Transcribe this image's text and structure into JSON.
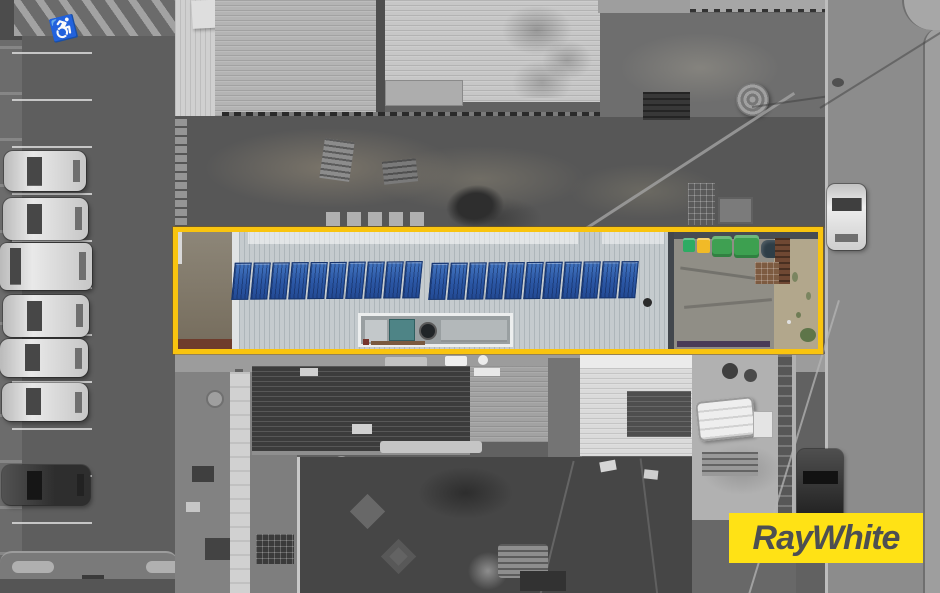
{
  "logo": {
    "text": "RayWhite",
    "background_color": "#FFE215",
    "text_color": "#4D4F52"
  },
  "property_overlay": {
    "shape": "rectangle",
    "boundary_color": "#F9C40F"
  },
  "icons": {
    "disabled_parking": "♿"
  },
  "scene": {
    "type": "aerial-drone-photograph",
    "style": "grayscale outside property boundary, full color inside",
    "solar_panels": {
      "row1_count": 10,
      "row2_count": 11,
      "total": 21,
      "panel_color": "#2B57A5"
    },
    "bins": {
      "colors": [
        "#2DAB63",
        "#F1BA27",
        "#3FA052"
      ]
    },
    "vehicles": {
      "parked_cars_in_lot": 7,
      "cars_on_road": 2
    }
  }
}
